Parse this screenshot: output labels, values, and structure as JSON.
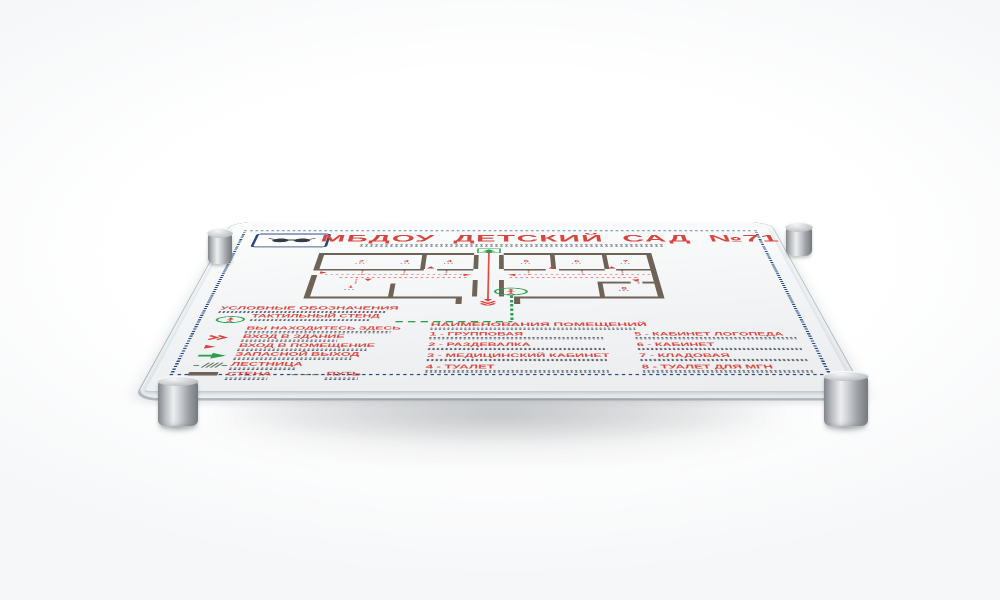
{
  "scene": {
    "description": "3D render of a white tactile evacuation-plan board with braille, mounted on four metal standoffs over a clear acrylic backing"
  },
  "colors": {
    "accent_red": "#d8443e",
    "accent_green": "#2aa04a",
    "border_blue": "#27497f",
    "wall_brown": "#6e6356",
    "plate_white": "#f4f5f6",
    "metal_gray": "#b9bcc0"
  },
  "sign": {
    "title": "МБДОУ  ДЕТСКИЙ САД №71",
    "legend": {
      "title": "УСЛОВНЫЕ ОБОЗНАЧЕНИЯ",
      "items": [
        {
          "icon": "you-are-here-icon",
          "label": "ТАКТИЛЬНЫЙ СТЕНД"
        },
        {
          "icon": "",
          "label": "ВЫ НАХОДИТЕСЬ ЗДЕСЬ"
        },
        {
          "icon": "building-entrance-icon",
          "label": "ВХОД В ЗДАНИЕ"
        },
        {
          "icon": "room-entrance-icon",
          "label": "ВХОД В ПОМЕЩЕНИЕ"
        },
        {
          "icon": "emergency-exit-icon",
          "label": "ЗАПАСНОЙ ВЫХОД"
        },
        {
          "icon": "stairs-icon",
          "label": "ЛЕСТНИЦА"
        },
        {
          "icon": "wall-icon",
          "label": "СТЕНА"
        },
        {
          "icon": "path-icon",
          "label": "ПУТЬ"
        }
      ]
    },
    "rooms": {
      "title": "НАИМЕНОВАНИЯ ПОМЕЩЕНИЙ",
      "column1": [
        "1 - ГРУППОВАЯ",
        "2 - РАЗДЕВАЛКА",
        "3 - МЕДИЦИНСКИЙ КАБИНЕТ",
        "4 - ТУАЛЕТ"
      ],
      "column2": [
        "5 - КАБИНЕТ ЛОГОПЕДА",
        "6 - КАБИНЕТ",
        "7 - КЛАДОВАЯ",
        "8 - ТУАЛЕТ ДЛЯ МГН"
      ]
    },
    "plan_markers": [
      "1",
      "2",
      "3",
      "4",
      "5",
      "6",
      "7",
      "8"
    ]
  }
}
